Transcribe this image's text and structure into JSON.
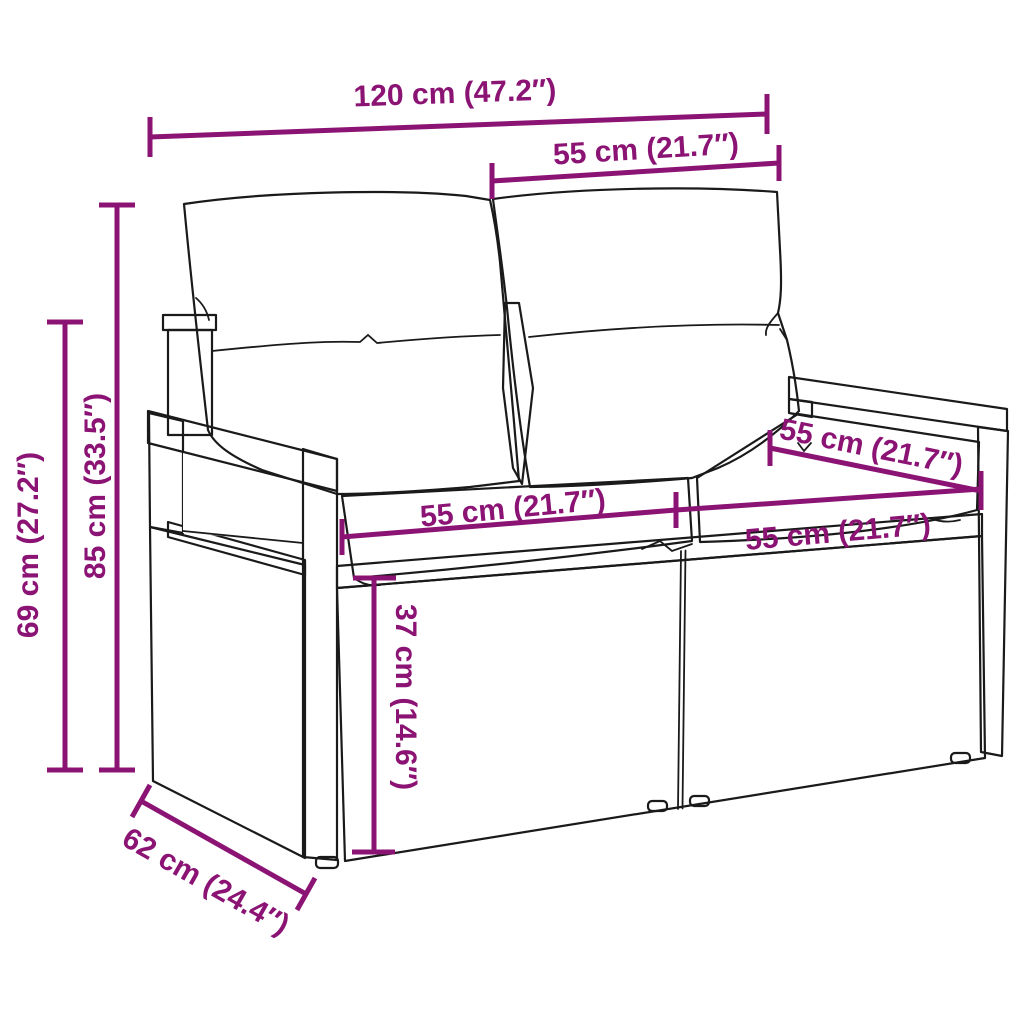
{
  "diagram": {
    "kind": "product-dimension-line-drawing",
    "subject": "poly-rattan-two-seater-garden-sofa-with-cushions",
    "colors": {
      "background": "#ffffff",
      "line_art": "#1a1a1a",
      "dimension_accent": "#8B1374"
    },
    "dimensions": [
      {
        "name": "overall-width",
        "label": "120 cm (47.2″)"
      },
      {
        "name": "back-cushion-width",
        "label": "55 cm (21.7″)"
      },
      {
        "name": "overall-height",
        "label": "85 cm (33.5″)"
      },
      {
        "name": "armrest-height",
        "label": "69 cm (27.2″)"
      },
      {
        "name": "seat-depth",
        "label": "55 cm (21.7″)"
      },
      {
        "name": "seat-width-left",
        "label": "55 cm (21.7″)"
      },
      {
        "name": "seat-width-right",
        "label": "55 cm (21.7″)"
      },
      {
        "name": "seat-height",
        "label": "37 cm (14.6″)"
      },
      {
        "name": "overall-depth",
        "label": "62 cm (24.4″)"
      }
    ]
  }
}
